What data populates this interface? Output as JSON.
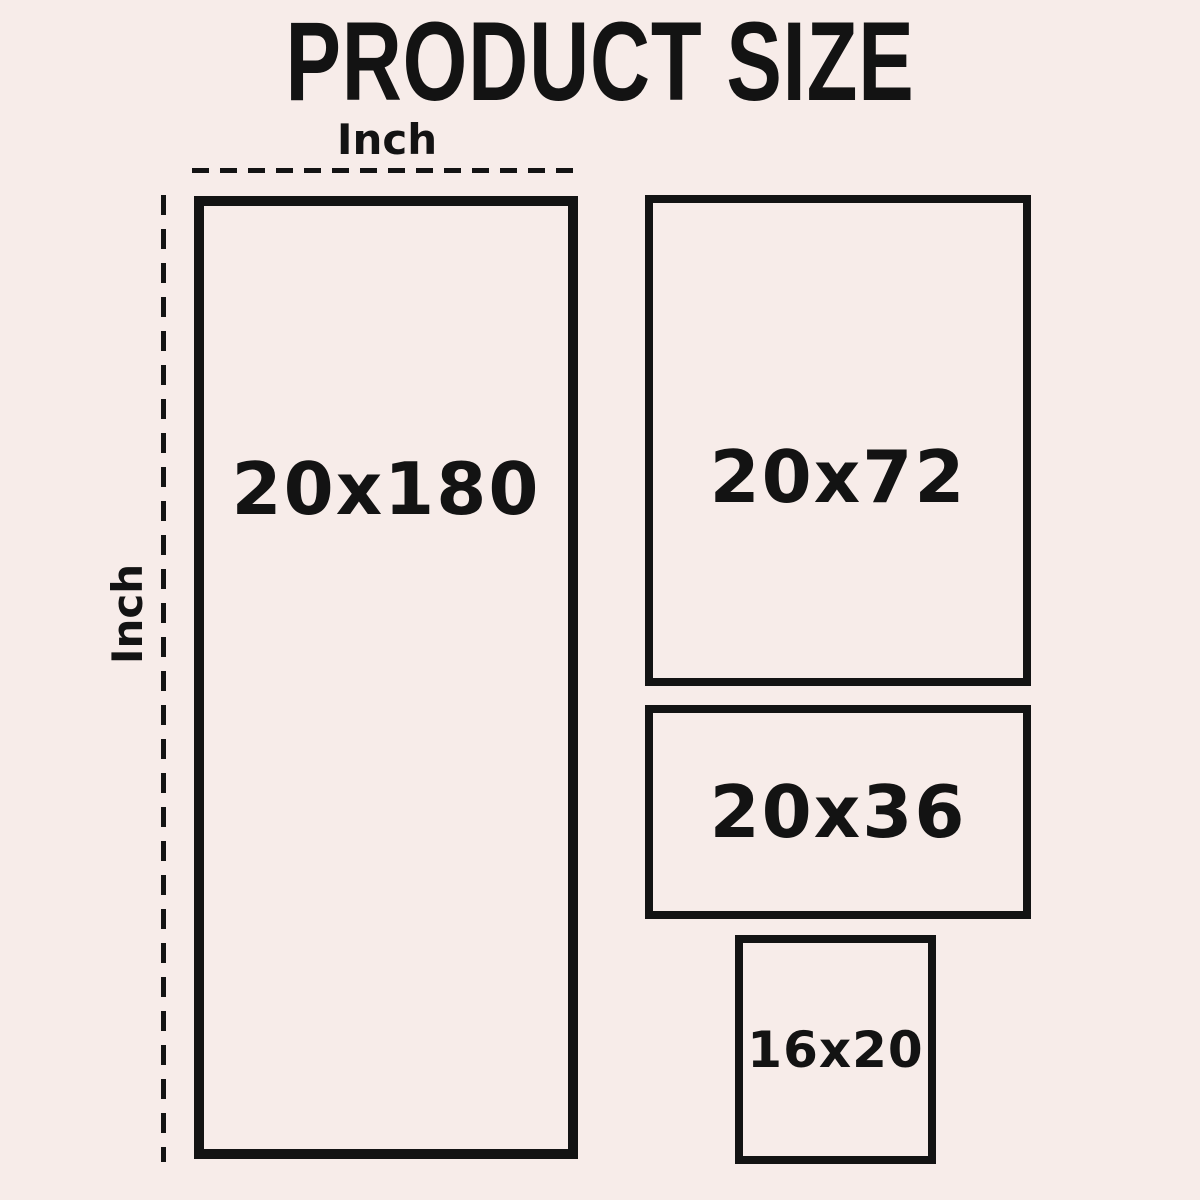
{
  "title": "PRODUCT SIZE",
  "axes": {
    "horizontal_label": "Inch",
    "vertical_label": "Inch"
  },
  "sizes": [
    {
      "label": "20x180",
      "width_inches": 20,
      "height_inches": 180
    },
    {
      "label": "20x72",
      "width_inches": 20,
      "height_inches": 72
    },
    {
      "label": "20x36",
      "width_inches": 20,
      "height_inches": 36
    },
    {
      "label": "16x20",
      "width_inches": 16,
      "height_inches": 20
    }
  ],
  "colors": {
    "background": "#f7ece9",
    "ink": "#131313"
  }
}
